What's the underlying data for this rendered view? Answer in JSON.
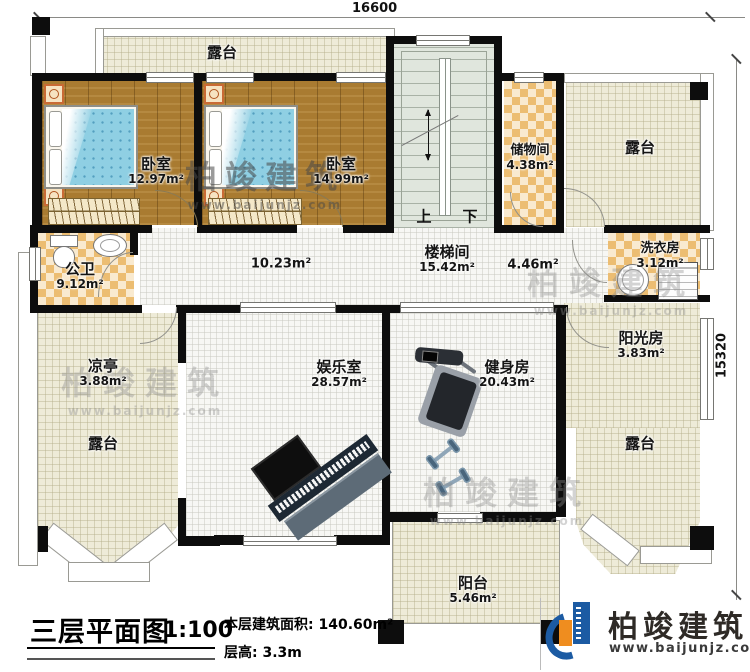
{
  "dimensions": {
    "top_width": "16600",
    "right_height": "15320"
  },
  "stairs": {
    "up": "上",
    "down": "下"
  },
  "rooms": {
    "terrace_top_left": {
      "name": "露台"
    },
    "bedroom_left": {
      "name": "卧室",
      "area": "12.97m²"
    },
    "bedroom_right": {
      "name": "卧室",
      "area": "14.99m²"
    },
    "storage": {
      "name": "储物间",
      "area": "4.38m²"
    },
    "terrace_top_right": {
      "name": "露台"
    },
    "bathroom": {
      "name": "公卫",
      "area": "9.12m²"
    },
    "hallway_left": {
      "area": "10.23m²"
    },
    "stairwell": {
      "name": "楼梯间",
      "area": "15.42m²"
    },
    "hallway_right": {
      "area": "4.46m²"
    },
    "laundry": {
      "name": "洗衣房",
      "area": "3.12m²"
    },
    "pavilion": {
      "name": "凉亭",
      "area": "3.88m²"
    },
    "terrace_left": {
      "name": "露台"
    },
    "entertainment": {
      "name": "娱乐室",
      "area": "28.57m²"
    },
    "gym": {
      "name": "健身房",
      "area": "20.43m²"
    },
    "sunroom": {
      "name": "阳光房",
      "area": "3.83m²"
    },
    "terrace_right": {
      "name": "露台"
    },
    "balcony": {
      "name": "阳台",
      "area": "5.46m²"
    }
  },
  "title_block": {
    "title": "三层平面图",
    "scale": "1:100",
    "floor_area": "本层建筑面积: 140.60m²",
    "floor_height": "层高: 3.3m"
  },
  "logo": {
    "brand": "柏竣建筑",
    "website": "www.baijunjz.com"
  },
  "watermark": {
    "brand": "柏竣建筑",
    "website": "www.baijunjz.com"
  },
  "colors": {
    "wall": "#0d0d0d",
    "terrace_fill": "#eeebd8",
    "tile_checker": "#ecbd72",
    "wood_floor": "#a97b31",
    "bed_blanket": "#8fcfe3",
    "logo_blue": "#1c5ba3",
    "logo_orange": "#ef8d1f"
  }
}
